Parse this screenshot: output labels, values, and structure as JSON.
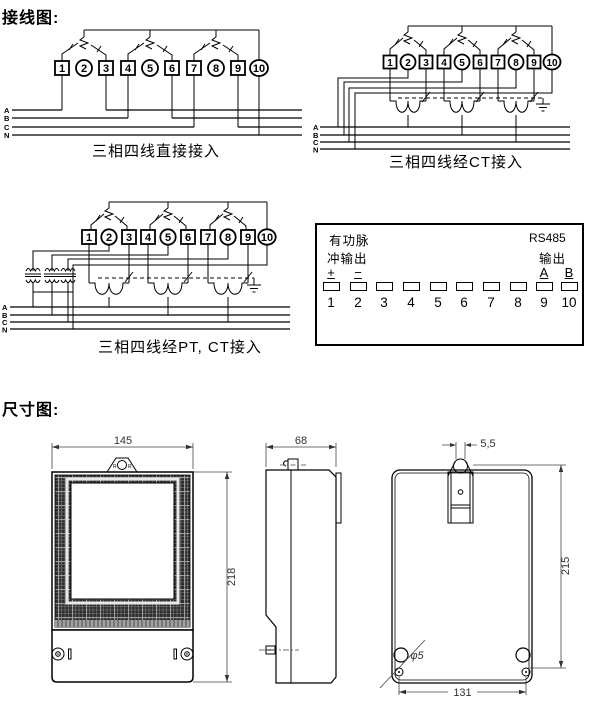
{
  "page": {
    "wiring_section_title": "接线图:",
    "dimension_section_title": "尺寸图:"
  },
  "wiring": {
    "terminals": [
      "1",
      "2",
      "3",
      "4",
      "5",
      "6",
      "7",
      "8",
      "9",
      "10"
    ],
    "bus_labels": [
      "A",
      "B",
      "C",
      "N"
    ],
    "diagram1_caption": "三相四线直接接入",
    "diagram2_caption": "三相四线经CT接入",
    "diagram3_caption": "三相四线经PT, CT接入"
  },
  "terminal_block": {
    "pulse_label_line1": "有功脉",
    "pulse_label_line2": "冲输出",
    "rs485_label": "RS485",
    "rs485_output_label": "输出",
    "plus_label": "+",
    "minus_label": "−",
    "a_label": "A",
    "b_label": "B",
    "numbers": [
      "1",
      "2",
      "3",
      "4",
      "5",
      "6",
      "7",
      "8",
      "9",
      "10"
    ]
  },
  "dimensions": {
    "front_width": "145",
    "front_height": "218",
    "side_depth": "68",
    "slot_width": "5,5",
    "back_height": "215",
    "hole_pitch": "131",
    "hole_diameter": "φ5",
    "tab_mark_left": "R",
    "tab_mark_right": "R"
  }
}
